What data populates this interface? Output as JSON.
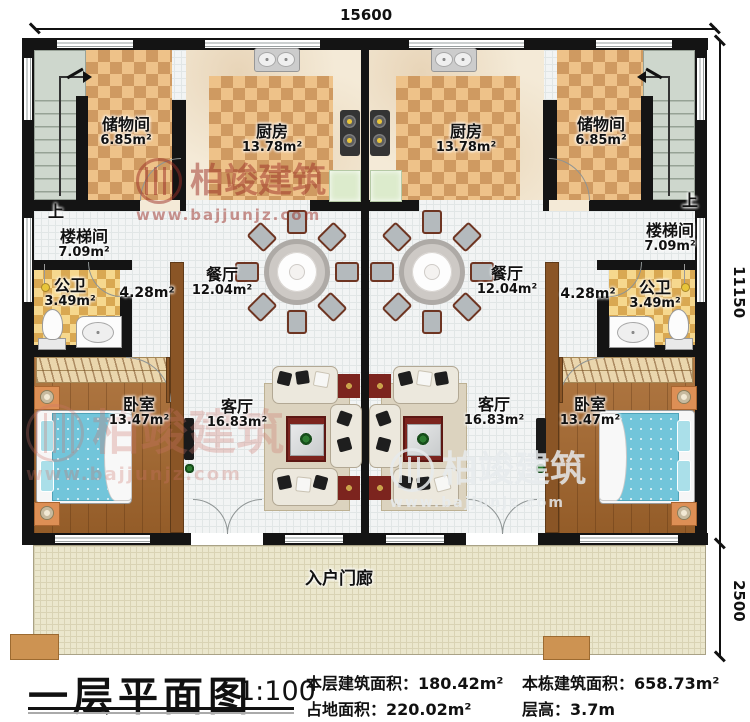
{
  "dimensions": {
    "top": "15600",
    "right_upper": "11150",
    "right_lower": "2500"
  },
  "stair_direction": "上",
  "rooms": {
    "storage": {
      "name": "储物间",
      "area": "6.85m²"
    },
    "kitchen": {
      "name": "厨房",
      "area": "13.78m²"
    },
    "stairwell": {
      "name": "楼梯间",
      "area": "7.09m²"
    },
    "bathroom": {
      "name": "公卫",
      "area": "3.49m²"
    },
    "hallway": {
      "area": "4.28m²"
    },
    "dining": {
      "name": "餐厅",
      "area": "12.04m²"
    },
    "living": {
      "name": "客厅",
      "area": "16.83m²"
    },
    "bedroom": {
      "name": "卧室",
      "area": "13.47m²"
    },
    "porch": {
      "name": "入户门廊"
    }
  },
  "watermark": {
    "brand": "柏竣建筑",
    "url": "www.bajjunjz.com"
  },
  "title_block": {
    "title": "一层平面图",
    "scale": "1:100",
    "floor_area": "本层建筑面积：180.42m²",
    "land_area": "占地面积：220.02m²",
    "building_area": "本栋建筑面积：658.73m²",
    "floor_height": "层高：3.7m"
  },
  "colors": {
    "wall": "#141414",
    "tile": "#eec289",
    "wood_floor": "#a8692e",
    "porch": "#ebe7cd",
    "bed": "#72c5da",
    "watermark_red": "#9b2d26"
  }
}
